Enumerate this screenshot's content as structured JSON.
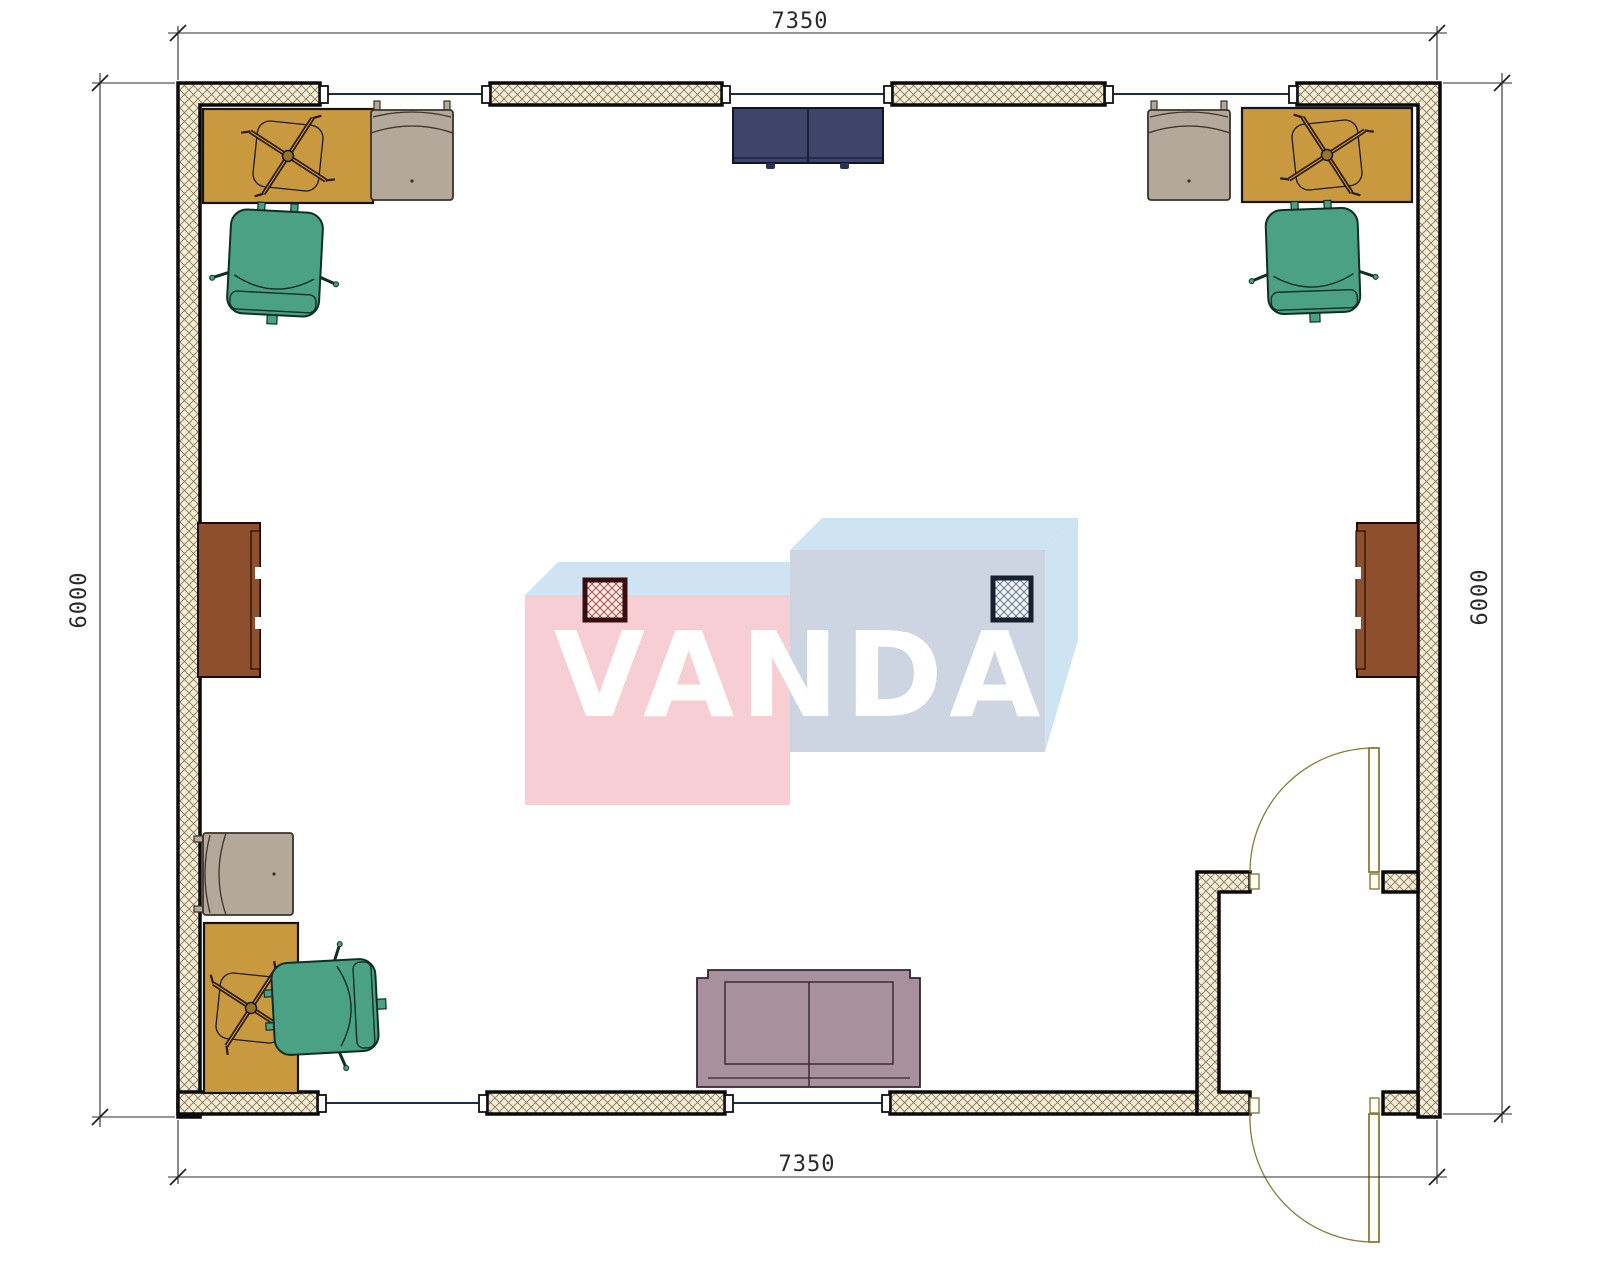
{
  "plan": {
    "type": "floor-plan",
    "dimensions": {
      "top": "7350",
      "bottom": "7350",
      "left": "6000",
      "right": "6000"
    },
    "watermark": {
      "text": "VANDA"
    },
    "colors": {
      "wall_fill": "#f3edda",
      "wall_hatch": "#8a7750",
      "wall_line": "#0a0a0a",
      "glazing": "#1d2c52",
      "desk": "#c9993f",
      "armchair": "#b3a89a",
      "office_chair": "#4ba183",
      "cabinet_top_center": "#3d4568",
      "cabinet_side": "#8d4f2e",
      "sofa": "#a8909d",
      "column_left_border": "#380d10",
      "column_right_border": "#16202e",
      "door": "#8a7a3a",
      "dimension_text": "#2b2b2b",
      "watermark_pink": "#f6ced4",
      "watermark_blue": "#cfe4f3",
      "watermark_gray": "#cdd5e2",
      "watermark_text": "#ffffff"
    },
    "furniture": [
      {
        "name": "desk-top-left"
      },
      {
        "name": "armchair-top-left"
      },
      {
        "name": "office-chair-top-left"
      },
      {
        "name": "storage-cabinet-top-center"
      },
      {
        "name": "armchair-top-right"
      },
      {
        "name": "desk-top-right"
      },
      {
        "name": "office-chair-top-right"
      },
      {
        "name": "cabinet-left-wall"
      },
      {
        "name": "cabinet-right-wall"
      },
      {
        "name": "column-left"
      },
      {
        "name": "column-right"
      },
      {
        "name": "armchair-bottom-left"
      },
      {
        "name": "desk-bottom-left"
      },
      {
        "name": "office-chair-bottom-left"
      },
      {
        "name": "sofa-bottom-center"
      }
    ],
    "openings": {
      "windows_top": 3,
      "windows_bottom": 2,
      "doors": 2
    }
  }
}
